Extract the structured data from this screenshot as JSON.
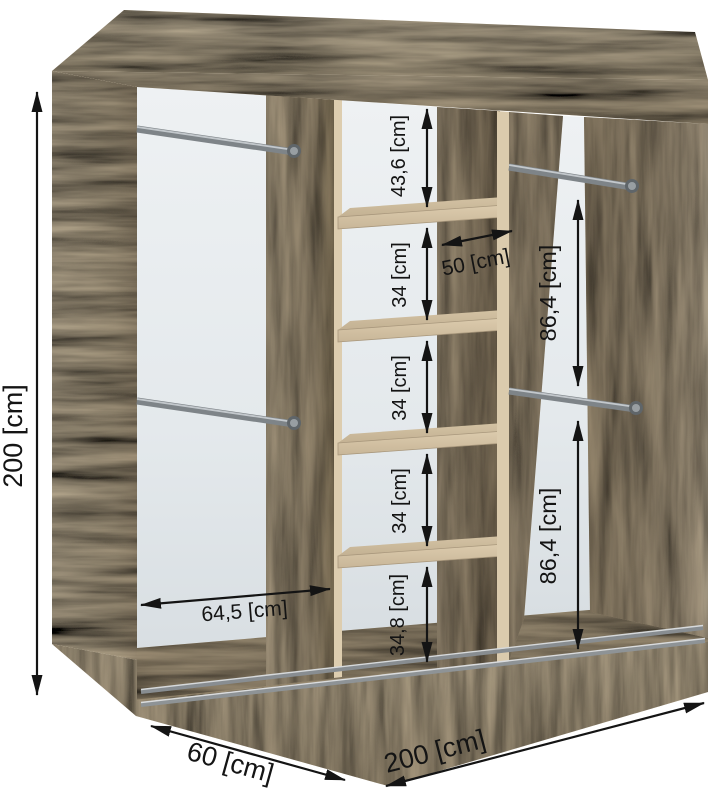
{
  "diagram": {
    "type": "furniture-dimension-diagram",
    "subject": "sliding-door wardrobe interior with shelves and hanging rails",
    "unit_suffix": "[cm]",
    "dimensions": {
      "height": "200 [cm]",
      "width": "200 [cm]",
      "depth": "60 [cm]",
      "left_compartment_width": "64,5 [cm]",
      "middle_shelf_width": "50 [cm]",
      "middle_sections": [
        "43,6 [cm]",
        "34 [cm]",
        "34 [cm]",
        "34 [cm]",
        "34,8 [cm]"
      ],
      "right_upper_section": "86,4 [cm]",
      "right_lower_section": "86,4 [cm]"
    },
    "colors": {
      "wood_top": "#d9c9ab",
      "wood_front_band": "#cfbfa1",
      "wood_side_panel": "#d3c2a3",
      "wood_divider": "#b9a88b",
      "wood_dark_interior": "#a4937a",
      "back_panel": "#e9edf0",
      "rail_metal": "#83898d",
      "dimension_ink": "#141414",
      "background": "#ffffff"
    }
  }
}
